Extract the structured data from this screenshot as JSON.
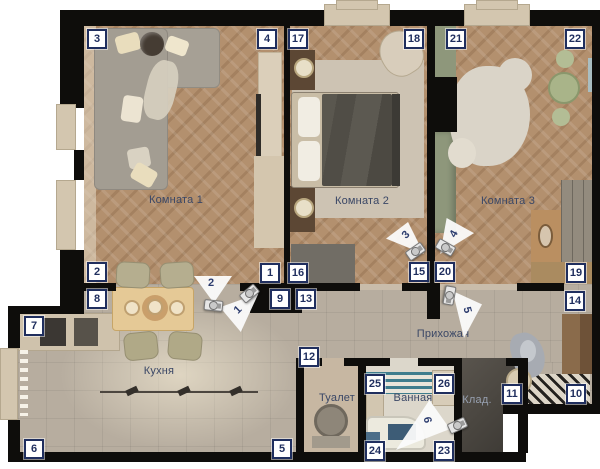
{
  "labels": {
    "room1": "Комната 1",
    "room2": "Комната 2",
    "room3": "Комната 3",
    "hallway": "Прихожая",
    "kitchen": "Кухня",
    "toilet": "Туалет",
    "bathroom": "Ванная",
    "storage": "Клад."
  },
  "markers": [
    {
      "n": "3",
      "x": 97,
      "y": 39
    },
    {
      "n": "4",
      "x": 267,
      "y": 39
    },
    {
      "n": "17",
      "x": 298,
      "y": 39
    },
    {
      "n": "18",
      "x": 414,
      "y": 39
    },
    {
      "n": "21",
      "x": 456,
      "y": 39
    },
    {
      "n": "22",
      "x": 575,
      "y": 39
    },
    {
      "n": "2",
      "x": 97,
      "y": 272
    },
    {
      "n": "1",
      "x": 270,
      "y": 273
    },
    {
      "n": "16",
      "x": 298,
      "y": 273
    },
    {
      "n": "15",
      "x": 419,
      "y": 272
    },
    {
      "n": "20",
      "x": 445,
      "y": 272
    },
    {
      "n": "19",
      "x": 576,
      "y": 273
    },
    {
      "n": "8",
      "x": 97,
      "y": 299
    },
    {
      "n": "9",
      "x": 280,
      "y": 299
    },
    {
      "n": "13",
      "x": 306,
      "y": 299
    },
    {
      "n": "14",
      "x": 575,
      "y": 301
    },
    {
      "n": "7",
      "x": 34,
      "y": 326
    },
    {
      "n": "12",
      "x": 309,
      "y": 357
    },
    {
      "n": "25",
      "x": 375,
      "y": 384
    },
    {
      "n": "26",
      "x": 444,
      "y": 384
    },
    {
      "n": "11",
      "x": 512,
      "y": 394
    },
    {
      "n": "10",
      "x": 576,
      "y": 394
    },
    {
      "n": "24",
      "x": 375,
      "y": 451
    },
    {
      "n": "23",
      "x": 444,
      "y": 451
    },
    {
      "n": "6",
      "x": 34,
      "y": 449
    },
    {
      "n": "5",
      "x": 282,
      "y": 449
    }
  ],
  "cameras": [
    {
      "n": "1"
    },
    {
      "n": "2"
    },
    {
      "n": "3"
    },
    {
      "n": "4"
    },
    {
      "n": "5"
    },
    {
      "n": "6"
    }
  ],
  "colors": {
    "marker_navy": "#1f2e5e",
    "label_blue": "#3a4766",
    "label_on_dark": "#97a0b0",
    "wall": "#0e0d0b",
    "wood": "#b3906e",
    "tile": "#b7ad9f",
    "teal": "#3f7d8d",
    "sage": "#8e977b"
  }
}
